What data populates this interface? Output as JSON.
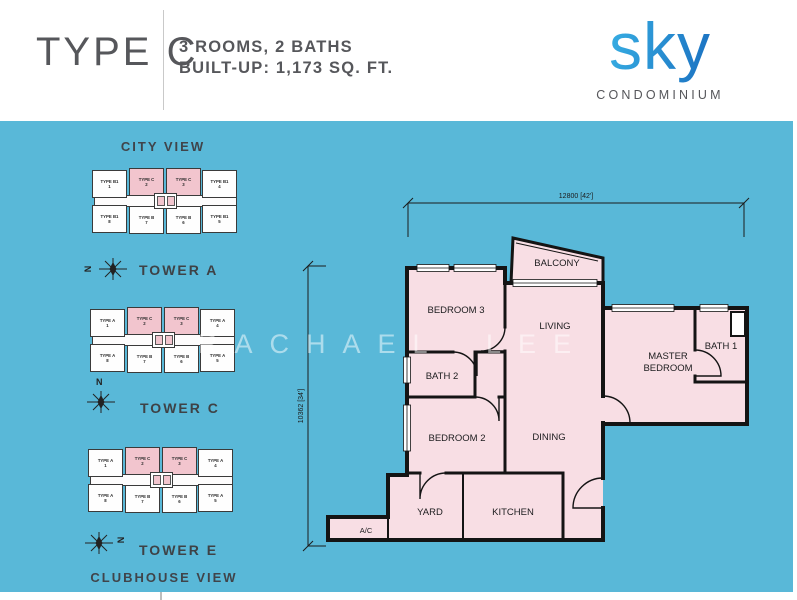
{
  "header": {
    "type_label": "TYPE C",
    "specs_line1": "3 ROOMS, 2 BATHS",
    "specs_line2": "BUILT-UP: 1,173 SQ. FT.",
    "logo_text": "sky",
    "logo_subtitle": "CONDOMINIUM"
  },
  "site_key": {
    "top_view_label": "CITY VIEW",
    "bottom_view_label": "CLUBHOUSE VIEW",
    "compass_letter": "N",
    "towers": [
      {
        "name": "TOWER A",
        "units": [
          {
            "type": "TYPE B1",
            "no": "1",
            "highlight": false
          },
          {
            "type": "TYPE C",
            "no": "2",
            "highlight": true
          },
          {
            "type": "TYPE C",
            "no": "3",
            "highlight": true
          },
          {
            "type": "TYPE B1",
            "no": "4",
            "highlight": false
          },
          {
            "type": "TYPE B1",
            "no": "8",
            "highlight": false
          },
          {
            "type": "TYPE B",
            "no": "7",
            "highlight": false
          },
          {
            "type": "TYPE B",
            "no": "6",
            "highlight": false
          },
          {
            "type": "TYPE B1",
            "no": "5",
            "highlight": false
          }
        ]
      },
      {
        "name": "TOWER C",
        "units": [
          {
            "type": "TYPE A",
            "no": "1",
            "highlight": false
          },
          {
            "type": "TYPE C",
            "no": "2",
            "highlight": true
          },
          {
            "type": "TYPE C",
            "no": "3",
            "highlight": true
          },
          {
            "type": "TYPE A",
            "no": "4",
            "highlight": false
          },
          {
            "type": "TYPE A",
            "no": "8",
            "highlight": false
          },
          {
            "type": "TYPE B",
            "no": "7",
            "highlight": false
          },
          {
            "type": "TYPE B",
            "no": "6",
            "highlight": false
          },
          {
            "type": "TYPE A",
            "no": "5",
            "highlight": false
          }
        ]
      },
      {
        "name": "TOWER E",
        "units": [
          {
            "type": "TYPE A",
            "no": "1",
            "highlight": false
          },
          {
            "type": "TYPE C",
            "no": "2",
            "highlight": true
          },
          {
            "type": "TYPE C",
            "no": "3",
            "highlight": true
          },
          {
            "type": "TYPE A",
            "no": "4",
            "highlight": false
          },
          {
            "type": "TYPE A",
            "no": "8",
            "highlight": false
          },
          {
            "type": "TYPE B",
            "no": "7",
            "highlight": false
          },
          {
            "type": "TYPE B",
            "no": "6",
            "highlight": false
          },
          {
            "type": "TYPE A",
            "no": "5",
            "highlight": false
          }
        ]
      }
    ]
  },
  "floorplan": {
    "dimension_width": "12800 [42']",
    "dimension_height": "10362 [34']",
    "rooms": {
      "balcony": "BALCONY",
      "bedroom3": "BEDROOM 3",
      "living": "LIVING",
      "master_line1": "MASTER",
      "master_line2": "BEDROOM",
      "bath1": "BATH 1",
      "bath2": "BATH 2",
      "bedroom2": "BEDROOM 2",
      "dining": "DINING",
      "yard": "YARD",
      "kitchen": "KITCHEN",
      "ac": "A/C"
    }
  },
  "watermark": "RACHAEL LEE",
  "colors": {
    "canvas_blue": "#59B8D8",
    "room_pink": "#F8DEE4",
    "highlight_pink": "#F2C5CE",
    "wall_black": "#141414",
    "logo_blue_start": "#36ACE2",
    "logo_blue_end": "#1A6FC0",
    "header_text": "#56575B"
  }
}
